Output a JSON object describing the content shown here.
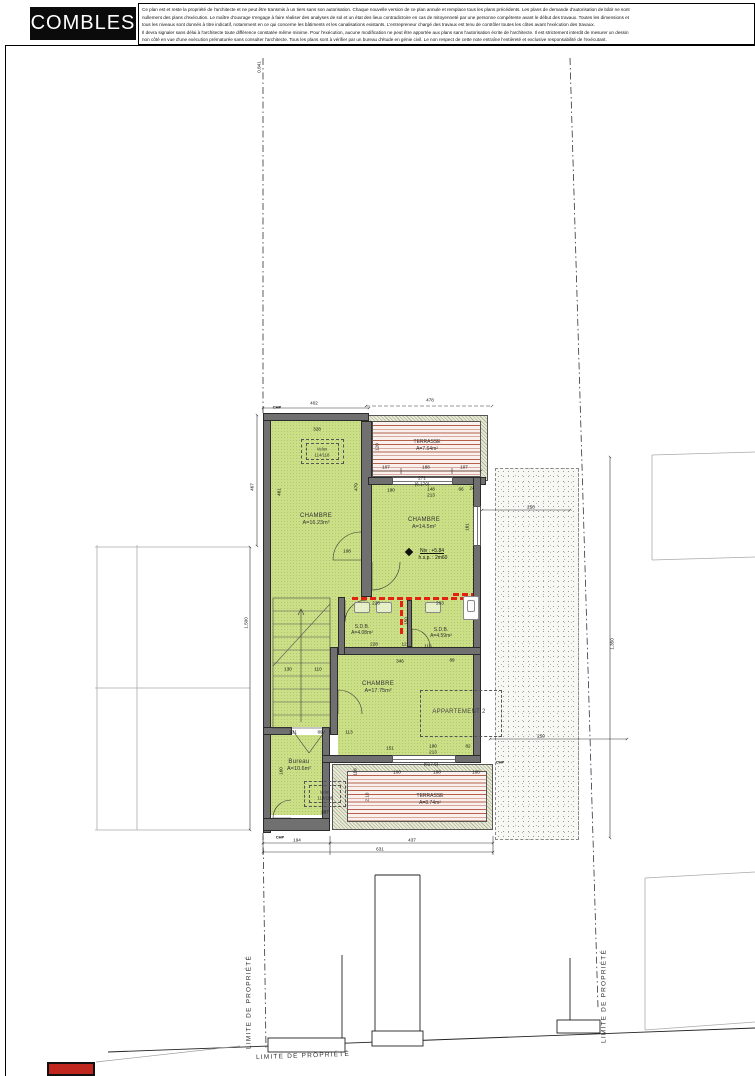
{
  "header": {
    "title": "COMBLES",
    "disclaimer_lines": [
      "Ce plan est et reste la propriété de l'architecte et ne peut être transmis à un tiers sans son autorisation. Chaque nouvelle version de ce plan annule et remplace tous les plans précédents. Les plans de demande d'autorisation de bâtir ne sont",
      "nullement des plans d'exécution. Le maître d'ouvrage s'engage à faire réaliser des analyses de sol et un état des lieux contradictoire en cas de mitoyenneté par une personne compétente avant le début des travaux. Toutes les dimensions et",
      "tous les niveaux sont donnés à titre indicatif, notamment en ce qui concerne les bâtiments et les canalisations existants. L'entrepreneur chargé des travaux est tenu de contrôler toutes les côtes avant l'exécution des travaux.",
      "Il devra signaler sans délai à l'architecte toute différence constatée même minime. Pour l'exécution, aucune modification ne peut être apportée aux plans sans l'autorisation écrite de l'architecte. Il est strictement interdit de mesurer un dessin",
      "non côté en vue d'une exécution prématurée sans consulter l'architecte. Tous les plans sont à vérifier par un bureau d'étude en génie civil. Le non respect de cette note entraîne l'entièreté et exclusive responsabilité de l'exécutant."
    ]
  },
  "rooms": [
    {
      "name": "CHAMBRE",
      "area": "A=16.23m²"
    },
    {
      "name": "CHAMBRE",
      "area": "A=14.5m²",
      "level": "Niv : +5.84",
      "ceiling": "h.s.p. : 2m60"
    },
    {
      "name": "CHAMBRE",
      "area": "A=17.75m²"
    },
    {
      "name": "Bureau",
      "area": "A=10.6m²"
    },
    {
      "name": "S.D.B.",
      "area": "A=4.08m²"
    },
    {
      "name": "S.D.B.",
      "area": "A=4.59m²"
    },
    {
      "name": "TERRASSE",
      "area": "A=7.64m²"
    },
    {
      "name": "TERRASSE",
      "area": "A=8.74m²"
    },
    {
      "name": "APPARTEMENT 2"
    }
  ],
  "colors": {
    "room_green": "#cbdf86",
    "wall_gray": "#707070",
    "deck_line": "#b4604a",
    "marking_red": "#e32212",
    "accent_red": "#c0271f"
  },
  "plan_labels": [
    {
      "t": "CHAMBRE",
      "x": 316,
      "y": 516,
      "k": "room"
    },
    {
      "t": "A=16.23m²",
      "x": 316,
      "y": 523,
      "k": "area"
    },
    {
      "t": "CHAMBRE",
      "x": 424,
      "y": 520,
      "k": "room"
    },
    {
      "t": "A=14.5m²",
      "x": 424,
      "y": 527,
      "k": "area"
    },
    {
      "t": "CHAMBRE",
      "x": 378,
      "y": 684,
      "k": "room"
    },
    {
      "t": "A=17.75m²",
      "x": 378,
      "y": 691,
      "k": "area"
    },
    {
      "t": "Bureau",
      "x": 299,
      "y": 762,
      "k": "room"
    },
    {
      "t": "A=10.6m²",
      "x": 299,
      "y": 769,
      "k": "area"
    },
    {
      "t": "S.D.B.",
      "x": 362,
      "y": 627,
      "k": "room-sm"
    },
    {
      "t": "A=4.08m²",
      "x": 362,
      "y": 633,
      "k": "area-sm"
    },
    {
      "t": "S.D.B.",
      "x": 441,
      "y": 630,
      "k": "room-sm"
    },
    {
      "t": "A=4.59m²",
      "x": 441,
      "y": 636,
      "k": "area-sm"
    },
    {
      "t": "TERRASSE",
      "x": 427,
      "y": 442,
      "k": "room-sm"
    },
    {
      "t": "A=7.64m²",
      "x": 427,
      "y": 449,
      "k": "area-sm"
    },
    {
      "t": "TERRASSE",
      "x": 430,
      "y": 796,
      "k": "room-sm"
    },
    {
      "t": "A=8.74m²",
      "x": 430,
      "y": 803,
      "k": "area-sm"
    },
    {
      "t": "APPARTEMENT 2",
      "x": 459,
      "y": 712,
      "k": "apartment"
    },
    {
      "t": "Velux",
      "x": 322,
      "y": 449,
      "k": "velux"
    },
    {
      "t": "114/118",
      "x": 322,
      "y": 455,
      "k": "velux"
    },
    {
      "t": "Velux",
      "x": 325,
      "y": 792,
      "k": "velux"
    },
    {
      "t": "114/118",
      "x": 325,
      "y": 798,
      "k": "velux"
    },
    {
      "t": "Niv : +5.84",
      "x": 432,
      "y": 551,
      "k": "level"
    },
    {
      "t": "h.s.p. : 2m60",
      "x": 433,
      "y": 558,
      "k": "level2"
    },
    {
      "t": "CHP",
      "x": 277,
      "y": 407,
      "k": "chp"
    },
    {
      "t": "CHP",
      "x": 280,
      "y": 837,
      "k": "chp"
    },
    {
      "t": "CHP",
      "x": 500,
      "y": 762,
      "k": "chp"
    },
    {
      "t": "402",
      "x": 314,
      "y": 403,
      "k": "dim"
    },
    {
      "t": "328",
      "x": 317,
      "y": 429,
      "k": "dim"
    },
    {
      "t": "478",
      "x": 430,
      "y": 400,
      "k": "dim"
    },
    {
      "t": "467",
      "x": 252,
      "y": 487,
      "k": "dim",
      "r": -90
    },
    {
      "t": "461",
      "x": 279,
      "y": 492,
      "k": "dim",
      "r": -90
    },
    {
      "t": "479",
      "x": 356,
      "y": 487,
      "k": "dim",
      "r": -90
    },
    {
      "t": "107",
      "x": 386,
      "y": 467,
      "k": "dim"
    },
    {
      "t": "188",
      "x": 426,
      "y": 467,
      "k": "dim"
    },
    {
      "t": "107",
      "x": 464,
      "y": 467,
      "k": "dim"
    },
    {
      "t": "120",
      "x": 377,
      "y": 447,
      "k": "dim",
      "r": -90
    },
    {
      "t": "271",
      "x": 422,
      "y": 478,
      "k": "dim"
    },
    {
      "t": "(6.170)",
      "x": 422,
      "y": 484,
      "k": "dim"
    },
    {
      "t": "190",
      "x": 391,
      "y": 490,
      "k": "dim"
    },
    {
      "t": "148",
      "x": 431,
      "y": 489,
      "k": "dim"
    },
    {
      "t": "213",
      "x": 431,
      "y": 495,
      "k": "dim"
    },
    {
      "t": "66",
      "x": 461,
      "y": 489,
      "k": "dim"
    },
    {
      "t": "24",
      "x": 472,
      "y": 488,
      "k": "dim"
    },
    {
      "t": "161",
      "x": 467,
      "y": 527,
      "k": "dim",
      "r": -90
    },
    {
      "t": "108",
      "x": 347,
      "y": 551,
      "k": "dim"
    },
    {
      "t": "226",
      "x": 376,
      "y": 603,
      "k": "dim"
    },
    {
      "t": "203",
      "x": 440,
      "y": 603,
      "k": "dim"
    },
    {
      "t": "150",
      "x": 406,
      "y": 621,
      "k": "dim",
      "r": -90
    },
    {
      "t": "228",
      "x": 374,
      "y": 644,
      "k": "dim"
    },
    {
      "t": "12",
      "x": 404,
      "y": 644,
      "k": "dim"
    },
    {
      "t": "116",
      "x": 428,
      "y": 646,
      "k": "dim"
    },
    {
      "t": "346",
      "x": 400,
      "y": 661,
      "k": "dim"
    },
    {
      "t": "89",
      "x": 452,
      "y": 660,
      "k": "dim"
    },
    {
      "t": "130",
      "x": 288,
      "y": 669,
      "k": "dim"
    },
    {
      "t": "110",
      "x": 318,
      "y": 669,
      "k": "dim"
    },
    {
      "t": "151",
      "x": 390,
      "y": 748,
      "k": "dim"
    },
    {
      "t": "190",
      "x": 433,
      "y": 746,
      "k": "dim"
    },
    {
      "t": "213",
      "x": 433,
      "y": 752,
      "k": "dim"
    },
    {
      "t": "82",
      "x": 468,
      "y": 746,
      "k": "dim"
    },
    {
      "t": "131",
      "x": 293,
      "y": 732,
      "k": "dim"
    },
    {
      "t": "89",
      "x": 320,
      "y": 732,
      "k": "dim"
    },
    {
      "t": "113",
      "x": 349,
      "y": 732,
      "k": "dim"
    },
    {
      "t": "287",
      "x": 325,
      "y": 812,
      "k": "dim"
    },
    {
      "t": "116",
      "x": 355,
      "y": 772,
      "k": "dim",
      "r": -90
    },
    {
      "t": "160",
      "x": 281,
      "y": 771,
      "k": "dim",
      "r": -90
    },
    {
      "t": "2.10",
      "x": 367,
      "y": 797,
      "k": "dim",
      "r": -90
    },
    {
      "t": "100",
      "x": 397,
      "y": 772,
      "k": "dim"
    },
    {
      "t": "188",
      "x": 437,
      "y": 772,
      "k": "dim"
    },
    {
      "t": "100",
      "x": 476,
      "y": 772,
      "k": "dim"
    },
    {
      "t": "(617.5)",
      "x": 431,
      "y": 764,
      "k": "dim"
    },
    {
      "t": "194",
      "x": 297,
      "y": 840,
      "k": "dim"
    },
    {
      "t": "437",
      "x": 412,
      "y": 840,
      "k": "dim"
    },
    {
      "t": "631",
      "x": 380,
      "y": 849,
      "k": "dim"
    },
    {
      "t": "250",
      "x": 531,
      "y": 507,
      "k": "dim"
    },
    {
      "t": "250",
      "x": 541,
      "y": 736,
      "k": "dim"
    },
    {
      "t": "1.350",
      "x": 612,
      "y": 644,
      "k": "dim",
      "r": -90
    },
    {
      "t": "1.500",
      "x": 246,
      "y": 623,
      "k": "dim",
      "r": -90
    },
    {
      "t": "0.841",
      "x": 259,
      "y": 67,
      "k": "dim",
      "r": -90
    },
    {
      "t": "LIMITE DE PROPRIÉTÉ",
      "x": 303,
      "y": 1056,
      "k": "limit",
      "r": -2
    },
    {
      "t": "LIMITE DE PROPRIÉTÉ",
      "x": 249,
      "y": 1002,
      "k": "limit",
      "r": -90
    },
    {
      "t": "LIMITE DE PROPRIÉTÉ",
      "x": 604,
      "y": 996,
      "k": "limit",
      "r": -90
    }
  ]
}
